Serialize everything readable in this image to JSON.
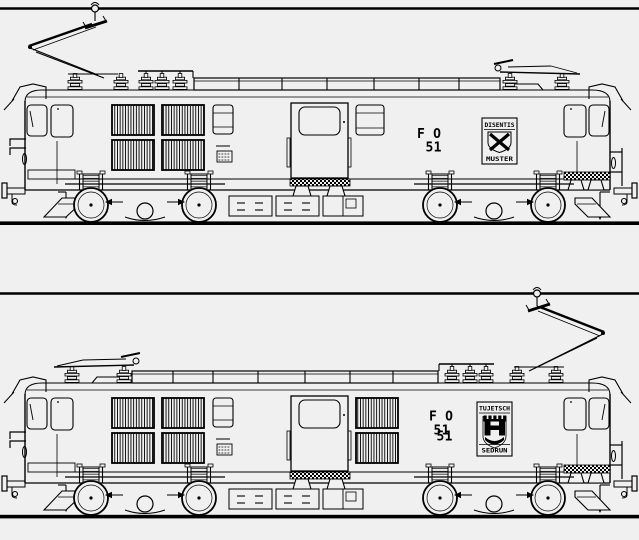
{
  "colors": {
    "background": "#f0f0f0",
    "ink": "#000000"
  },
  "locomotives": [
    {
      "operator": "F O",
      "number": "51",
      "pantograph_state": "front-raised",
      "crest": {
        "top_text": "DISENTIS",
        "bottom_text": "MUSTER",
        "emblem": "saltire-shield"
      }
    },
    {
      "operator": "F O",
      "number": "51",
      "number_overprint": "51",
      "pantograph_state": "rear-raised",
      "crest": {
        "top_text": "TUJETSCH",
        "bottom_text": "SEDRUN",
        "emblem": "castle-shield"
      }
    }
  ]
}
